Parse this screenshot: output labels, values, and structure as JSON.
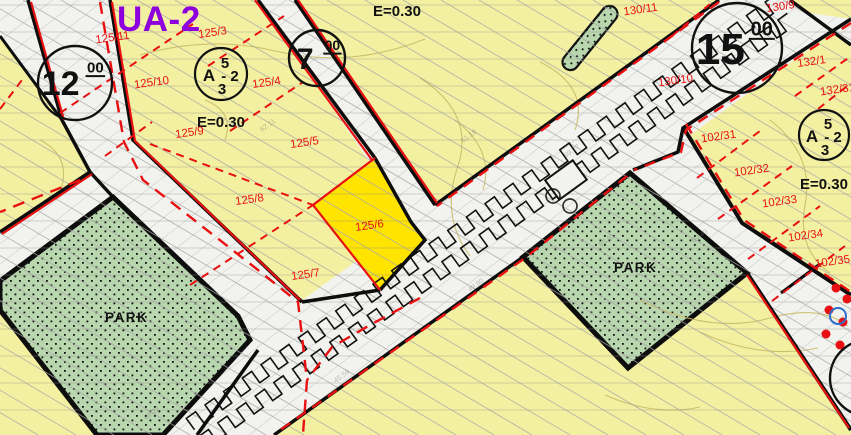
{
  "map": {
    "colors": {
      "parcel_fill": "#f4f0a2",
      "highlight_fill": "#ffe400",
      "park_fill": "#b9d7ae",
      "road_fill": "#f2f2ef",
      "road_hatch": "#c6c6c2",
      "red": "#e81010",
      "purple": "#8d00dd",
      "black": "#0d0d0d",
      "hatch": "#a8a8a8",
      "contour": "#c9bd66",
      "blue": "#2e6fcf",
      "scanline": "#909090",
      "survey_gray": "#6f6f6f"
    },
    "zone_label": {
      "text": "UA-2",
      "x": 117,
      "y": 31,
      "size": 35
    },
    "coeff_labels": [
      {
        "text": "E=0.30",
        "x": 373,
        "y": 16
      },
      {
        "text": "E=0.30",
        "x": 197,
        "y": 127
      },
      {
        "text": "E=0.30",
        "x": 800,
        "y": 189
      }
    ],
    "park_labels": [
      {
        "text": "PARK",
        "x": 105,
        "y": 322
      },
      {
        "text": "PARK",
        "x": 614,
        "y": 272
      }
    ],
    "parcel_labels": [
      {
        "text": "125/11",
        "x": 113,
        "y": 41
      },
      {
        "text": "125/3",
        "x": 213,
        "y": 36
      },
      {
        "text": "125/10",
        "x": 152,
        "y": 86
      },
      {
        "text": "125/4",
        "x": 267,
        "y": 86
      },
      {
        "text": "125/9",
        "x": 190,
        "y": 136
      },
      {
        "text": "125/5",
        "x": 305,
        "y": 146
      },
      {
        "text": "125/8",
        "x": 250,
        "y": 203
      },
      {
        "text": "125/6",
        "x": 370,
        "y": 229
      },
      {
        "text": "125/7",
        "x": 306,
        "y": 278
      },
      {
        "text": "130/11",
        "x": 641,
        "y": 13
      },
      {
        "text": "130/9",
        "x": 781,
        "y": 10
      },
      {
        "text": "130/10",
        "x": 676,
        "y": 84
      },
      {
        "text": "132/1",
        "x": 812,
        "y": 65
      },
      {
        "text": "132/31",
        "x": 838,
        "y": 93
      },
      {
        "text": "102/31",
        "x": 719,
        "y": 140
      },
      {
        "text": "102/32",
        "x": 752,
        "y": 174
      },
      {
        "text": "102/33",
        "x": 780,
        "y": 205
      },
      {
        "text": "102/34",
        "x": 806,
        "y": 239
      },
      {
        "text": "102/35",
        "x": 833,
        "y": 265
      }
    ],
    "road_width_badges": [
      {
        "value": "12",
        "sup": "00",
        "cx": 75,
        "cy": 83,
        "r": 37,
        "main_size": 34,
        "sup_size": 15
      },
      {
        "value": "7",
        "sup": "00",
        "cx": 317,
        "cy": 58,
        "r": 28,
        "main_size": 30,
        "sup_size": 14
      },
      {
        "value": "15",
        "sup": "00",
        "cx": 737,
        "cy": 48,
        "r": 45,
        "main_size": 44,
        "sup_size": 20
      },
      {
        "value": "7",
        "sup": "",
        "cx": 868,
        "cy": 378,
        "r": 38,
        "main_size": 36,
        "sup_size": 0
      }
    ],
    "zoning_symbols": [
      {
        "cx": 221,
        "cy": 74,
        "r": 26,
        "letter": "A",
        "top": "5",
        "mid": "- 2",
        "bottom": "3"
      },
      {
        "cx": 824,
        "cy": 135,
        "r": 25,
        "letter": "A",
        "top": "5",
        "mid": "- 2",
        "bottom": "3"
      }
    ],
    "survey_marks": [
      {
        "t": "69.27",
        "x": 566,
        "y": 158
      },
      {
        "t": "65.31",
        "x": 601,
        "y": 247
      },
      {
        "t": "45.59",
        "x": 336,
        "y": 383
      },
      {
        "t": "49.80",
        "x": 470,
        "y": 292
      },
      {
        "t": "69.22",
        "x": 146,
        "y": 420
      },
      {
        "t": "69.40",
        "x": 694,
        "y": 243
      },
      {
        "t": "62.11",
        "x": 262,
        "y": 132
      },
      {
        "t": "61.18",
        "x": 463,
        "y": 143
      }
    ],
    "geometry": {
      "roads": [
        [
          [
            719,
            0
          ],
          [
            851,
            19
          ],
          [
            274,
            435
          ],
          [
            115,
            435
          ]
        ],
        [
          [
            719,
            0
          ],
          [
            790,
            0
          ],
          [
            851,
            45
          ],
          [
            851,
            19
          ]
        ],
        [
          [
            258,
            0
          ],
          [
            295,
            0
          ],
          [
            435,
            205
          ],
          [
            411,
            222
          ]
        ],
        [
          [
            28,
            0
          ],
          [
            110,
            0
          ],
          [
            133,
            140
          ],
          [
            305,
            302
          ],
          [
            280,
            328
          ],
          [
            113,
            197
          ],
          [
            90,
            172
          ],
          [
            62,
            120
          ]
        ],
        [
          [
            90,
            172
          ],
          [
            113,
            197
          ],
          [
            0,
            285
          ],
          [
            0,
            232
          ]
        ],
        [
          [
            0,
            0
          ],
          [
            28,
            0
          ],
          [
            62,
            120
          ],
          [
            0,
            36
          ]
        ],
        [
          [
            113,
            197
          ],
          [
            305,
            302
          ],
          [
            197,
            435
          ],
          [
            95,
            435
          ]
        ],
        [
          [
            683,
            127
          ],
          [
            742,
            223
          ],
          [
            851,
            295
          ],
          [
            851,
            430
          ],
          [
            747,
            273
          ],
          [
            630,
            173
          ]
        ]
      ],
      "parks": [
        [
          [
            113,
            197
          ],
          [
            238,
            316
          ],
          [
            250,
            340
          ],
          [
            163,
            435
          ],
          [
            97,
            435
          ],
          [
            0,
            310
          ],
          [
            0,
            281
          ]
        ],
        [
          [
            630,
            173
          ],
          [
            747,
            273
          ],
          [
            628,
            368
          ],
          [
            523,
            257
          ]
        ]
      ],
      "highlight_parcel": [
        [
          375,
          158
        ],
        [
          411,
          222
        ],
        [
          425,
          240
        ],
        [
          380,
          290
        ],
        [
          313,
          205
        ]
      ],
      "median_strip": {
        "cx": 590,
        "cy": 38,
        "len": 78,
        "wid": 16,
        "angle": 51
      },
      "rect_symbol": {
        "cx": 566,
        "cy": 180,
        "w": 34,
        "h": 24,
        "angle": -36
      },
      "symbol_circles": [
        [
          553,
          196
        ],
        [
          570,
          206
        ]
      ],
      "red_dots": [
        [
          836,
          288
        ],
        [
          847,
          299
        ],
        [
          829,
          310
        ],
        [
          843,
          322
        ],
        [
          826,
          334
        ],
        [
          840,
          345
        ]
      ],
      "blue_circle": {
        "cx": 838,
        "cy": 316,
        "r": 8
      },
      "black_lines": [
        {
          "pts": [
            [
              719,
              0
            ],
            [
              435,
              205
            ]
          ],
          "w": 3.5
        },
        {
          "pts": [
            [
              851,
              19
            ],
            [
              683,
              128
            ],
            [
              678,
              152
            ],
            [
              633,
              170
            ]
          ],
          "w": 3.5
        },
        {
          "pts": [
            [
              523,
              257
            ],
            [
              274,
              435
            ]
          ],
          "w": 3.5
        },
        {
          "pts": [
            [
              258,
              0
            ],
            [
              375,
              158
            ]
          ],
          "w": 3.5
        },
        {
          "pts": [
            [
              295,
              0
            ],
            [
              435,
              205
            ]
          ],
          "w": 3.5
        },
        {
          "pts": [
            [
              28,
              0
            ],
            [
              62,
              120
            ],
            [
              90,
              172
            ],
            [
              113,
              197
            ]
          ],
          "w": 3.5
        },
        {
          "pts": [
            [
              110,
              0
            ],
            [
              133,
              140
            ],
            [
              302,
              302
            ]
          ],
          "w": 3.5
        },
        {
          "pts": [
            [
              90,
              172
            ],
            [
              0,
              232
            ]
          ],
          "w": 3.5
        },
        {
          "pts": [
            [
              380,
              290
            ],
            [
              302,
              302
            ]
          ],
          "w": 3.5
        },
        {
          "pts": [
            [
              258,
              350
            ],
            [
              197,
              435
            ]
          ],
          "w": 3.5
        },
        {
          "pts": [
            [
              790,
              0
            ],
            [
              851,
              45
            ]
          ],
          "w": 3.5
        },
        {
          "pts": [
            [
              683,
              127
            ],
            [
              742,
              223
            ],
            [
              851,
              295
            ]
          ],
          "w": 4
        },
        {
          "pts": [
            [
              747,
              273
            ],
            [
              851,
              430
            ]
          ],
          "w": 4
        },
        {
          "pts": [
            [
              0,
              36
            ],
            [
              62,
              120
            ]
          ],
          "w": 3
        },
        {
          "pts": [
            [
              781,
              293
            ],
            [
              820,
              264
            ]
          ],
          "w": 3
        },
        {
          "pts": [
            [
              375,
              158
            ],
            [
              411,
              222
            ],
            [
              425,
              240
            ],
            [
              380,
              290
            ]
          ],
          "w": 3.5
        }
      ],
      "red_solid": [
        [
          [
            112,
            2
          ],
          [
            135,
            141
          ],
          [
            300,
            300
          ]
        ],
        [
          [
            31,
            2
          ],
          [
            64,
            120
          ]
        ],
        [
          [
            92,
            174
          ],
          [
            2,
            234
          ]
        ],
        [
          [
            255,
            0
          ],
          [
            372,
            160
          ]
        ],
        [
          [
            298,
            0
          ],
          [
            437,
            203
          ]
        ],
        [
          [
            747,
            275
          ],
          [
            849,
            428
          ]
        ],
        [
          [
            380,
            290
          ],
          [
            313,
            205
          ],
          [
            375,
            158
          ]
        ]
      ],
      "red_dashed": [
        {
          "pts": [
            [
              719,
              2
            ],
            [
              437,
              206
            ]
          ],
          "dash": "11 8",
          "w": 2.4
        },
        {
          "pts": [
            [
              851,
              23
            ],
            [
              686,
              130
            ],
            [
              681,
              152
            ],
            [
              634,
              170
            ]
          ],
          "dash": "11 8",
          "w": 2.4
        },
        {
          "pts": [
            [
              627,
              176
            ],
            [
              525,
              258
            ],
            [
              276,
              433
            ]
          ],
          "dash": "11 8",
          "w": 2.4
        },
        {
          "pts": [
            [
              686,
              124
            ],
            [
              744,
              220
            ],
            [
              851,
              292
            ]
          ],
          "dash": "11 8",
          "w": 2.4
        },
        {
          "pts": [
            [
              100,
              2
            ],
            [
              124,
              142
            ],
            [
              143,
              180
            ],
            [
              258,
              270
            ],
            [
              298,
              302
            ],
            [
              307,
              380
            ],
            [
              303,
              434
            ]
          ],
          "dash": "12 8",
          "w": 2.4
        },
        {
          "pts": [
            [
              420,
              298
            ],
            [
              370,
              325
            ],
            [
              332,
              347
            ],
            [
              307,
              380
            ]
          ],
          "dash": "12 8",
          "w": 2.4
        },
        {
          "pts": [
            [
              80,
              180
            ],
            [
              0,
              212
            ]
          ],
          "dash": "12 8",
          "w": 2.4
        },
        {
          "pts": [
            [
              208,
              66
            ],
            [
              284,
              16
            ]
          ],
          "dash": "8 6",
          "w": 2
        },
        {
          "pts": [
            [
              230,
              131
            ],
            [
              303,
              82
            ]
          ],
          "dash": "8 6",
          "w": 2
        },
        {
          "pts": [
            [
              190,
              285
            ],
            [
              313,
              205
            ]
          ],
          "dash": "8 6",
          "w": 2
        },
        {
          "pts": [
            [
              150,
              144
            ],
            [
              313,
              205
            ]
          ],
          "dash": "8 6",
          "w": 2
        },
        {
          "pts": [
            [
              105,
              156
            ],
            [
              152,
              122
            ]
          ],
          "dash": "8 6",
          "w": 2
        },
        {
          "pts": [
            [
              60,
              113
            ],
            [
              193,
              24
            ]
          ],
          "dash": "8 6",
          "w": 2
        },
        {
          "pts": [
            [
              0,
              109
            ],
            [
              22,
              80
            ]
          ],
          "dash": "8 6",
          "w": 2
        },
        {
          "pts": [
            [
              697,
              178
            ],
            [
              764,
              128
            ]
          ],
          "dash": "8 6",
          "w": 2
        },
        {
          "pts": [
            [
              718,
              219
            ],
            [
              792,
              166
            ]
          ],
          "dash": "8 6",
          "w": 2
        },
        {
          "pts": [
            [
              748,
              259
            ],
            [
              820,
              206
            ]
          ],
          "dash": "8 6",
          "w": 2
        },
        {
          "pts": [
            [
              772,
              301
            ],
            [
              845,
              246
            ]
          ],
          "dash": "8 6",
          "w": 2
        },
        {
          "pts": [
            [
              818,
              109
            ],
            [
              851,
              83
            ]
          ],
          "dash": "8 6",
          "w": 2
        },
        {
          "pts": [
            [
              795,
              96
            ],
            [
              851,
              56
            ]
          ],
          "dash": "8 6",
          "w": 2
        },
        {
          "pts": [
            [
              672,
              36
            ],
            [
              710,
              4
            ]
          ],
          "dash": "8 6",
          "w": 2
        }
      ],
      "contours": [
        "M140,55 q70,-20 135,-4 q75,18 150,-12",
        "M420,78 q55,35 38,88 q-18,50 12,90",
        "M455,120 q40,30 28,70",
        "M40,140 q35,18 18,58",
        "M640,300 q70,35 130,18 q50,-14 78,8",
        "M700,332 q60,28 118,16",
        "M770,120 q45,35 35,85 q-8,45 25,68",
        "M540,62 q50,25 35,68",
        "M205,100 q30,12 20,40",
        "M605,395 q50,22 95,12"
      ],
      "hatch": {
        "slope": 0.59,
        "spacing": 38,
        "run": 737
      },
      "scanlines": {
        "start": 5,
        "step": 27
      },
      "wave": {
        "x1": 785,
        "y1": 10,
        "x2": 194,
        "y2": 435,
        "offsets": [
          -11,
          11
        ],
        "amp": 7,
        "period": 23
      }
    }
  }
}
